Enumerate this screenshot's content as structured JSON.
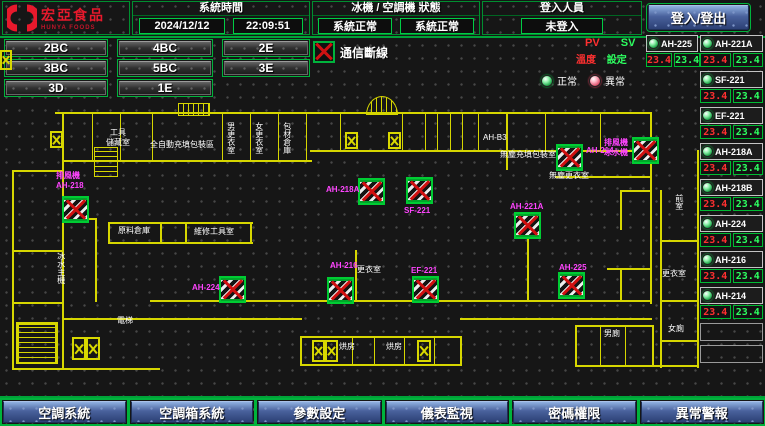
{
  "header": {
    "logo_title": "宏亞食品",
    "logo_subtitle": "HUNYA FOODS",
    "system_time_label": "系統時間",
    "date": "2024/12/12",
    "time": "22:09:51",
    "machine_status_label": "冰機 / 空調機 狀態",
    "chiller_status": "系統正常",
    "ahu_status": "系統正常",
    "login_label": "登入人員",
    "login_value": "未登入",
    "login_button": "登入/登出"
  },
  "floor_nav": {
    "rows": [
      [
        "2BC",
        "4BC",
        "2E"
      ],
      [
        "3BC",
        "5BC",
        "3E"
      ],
      [
        "3D",
        "1E"
      ]
    ]
  },
  "legend": {
    "comm_loss": "通信斷線",
    "pv": "PV",
    "sv": "SV",
    "pv_name": "溫度",
    "sv_name": "設定",
    "normal": "正常",
    "abnormal": "異常",
    "pv_color": "#ff3030",
    "sv_color": "#2dff60",
    "normal_color": "#22aa4e",
    "abnormal_color": "#e05570"
  },
  "units_panel": {
    "left": [
      {
        "name": "AH-225",
        "pv": "23.4",
        "sv": "23.4",
        "status": "normal"
      }
    ],
    "right": [
      {
        "name": "AH-221A",
        "pv": "23.4",
        "sv": "23.4",
        "status": "normal"
      },
      {
        "name": "SF-221",
        "pv": "23.4",
        "sv": "23.4",
        "status": "normal"
      },
      {
        "name": "EF-221",
        "pv": "23.4",
        "sv": "23.4",
        "status": "normal"
      },
      {
        "name": "AH-218A",
        "pv": "23.4",
        "sv": "23.4",
        "status": "normal"
      },
      {
        "name": "AH-218B",
        "pv": "23.4",
        "sv": "23.4",
        "status": "normal"
      },
      {
        "name": "AH-224",
        "pv": "23.4",
        "sv": "23.4",
        "status": "normal"
      },
      {
        "name": "AH-216",
        "pv": "23.4",
        "sv": "23.4",
        "status": "normal"
      },
      {
        "name": "AH-214",
        "pv": "23.4",
        "sv": "23.4",
        "status": "normal"
      }
    ],
    "spare_slots": 2
  },
  "floorplan": {
    "ahu_icons": [
      {
        "x": 62,
        "y": 196
      },
      {
        "x": 358,
        "y": 178
      },
      {
        "x": 406,
        "y": 177
      },
      {
        "x": 556,
        "y": 144
      },
      {
        "x": 632,
        "y": 137
      },
      {
        "x": 514,
        "y": 212
      },
      {
        "x": 219,
        "y": 276
      },
      {
        "x": 327,
        "y": 277
      },
      {
        "x": 412,
        "y": 276
      },
      {
        "x": 558,
        "y": 272
      }
    ],
    "dampers": [
      {
        "x": 345,
        "y": 132,
        "w": 13,
        "h": 17
      },
      {
        "x": 388,
        "y": 132,
        "w": 13,
        "h": 17
      },
      {
        "x": 72,
        "y": 337,
        "w": 14,
        "h": 23
      },
      {
        "x": 86,
        "y": 337,
        "w": 14,
        "h": 23
      },
      {
        "x": 312,
        "y": 340,
        "w": 13,
        "h": 22
      },
      {
        "x": 325,
        "y": 340,
        "w": 13,
        "h": 22
      },
      {
        "x": 417,
        "y": 340,
        "w": 14,
        "h": 22
      },
      {
        "x": 0,
        "y": 50,
        "w": 12,
        "h": 20
      },
      {
        "x": 50,
        "y": 131,
        "w": 13,
        "h": 17
      }
    ],
    "labels": [
      {
        "t": "排風機",
        "x": 56,
        "y": 172,
        "c": "m"
      },
      {
        "t": "AH-218",
        "x": 56,
        "y": 182,
        "c": "m"
      },
      {
        "t": "AH-218A",
        "x": 326,
        "y": 186,
        "c": "m"
      },
      {
        "t": "SF-221",
        "x": 404,
        "y": 207,
        "c": "m"
      },
      {
        "t": "AH-214",
        "x": 586,
        "y": 147,
        "c": "m"
      },
      {
        "t": "無塵充填包裝室",
        "x": 500,
        "y": 151,
        "c": "w"
      },
      {
        "t": "無塵更衣室",
        "x": 549,
        "y": 172,
        "c": "w"
      },
      {
        "t": "排風機",
        "x": 604,
        "y": 139,
        "c": "m"
      },
      {
        "t": "冰水機",
        "x": 604,
        "y": 149,
        "c": "m"
      },
      {
        "t": "AH-221A",
        "x": 510,
        "y": 203,
        "c": "m"
      },
      {
        "t": "AH-224",
        "x": 192,
        "y": 284,
        "c": "m"
      },
      {
        "t": "AH-216",
        "x": 330,
        "y": 262,
        "c": "m"
      },
      {
        "t": "更衣室",
        "x": 357,
        "y": 266,
        "c": "w"
      },
      {
        "t": "EF-221",
        "x": 411,
        "y": 267,
        "c": "m"
      },
      {
        "t": "AH-225",
        "x": 559,
        "y": 264,
        "c": "m"
      },
      {
        "t": "工具",
        "x": 110,
        "y": 129,
        "c": "w"
      },
      {
        "t": "儲藏室",
        "x": 106,
        "y": 139,
        "c": "w"
      },
      {
        "t": "全自動充填包裝區",
        "x": 150,
        "y": 141,
        "c": "w"
      },
      {
        "t": "男更衣室",
        "x": 226,
        "y": 122,
        "c": "w",
        "v": true
      },
      {
        "t": "女更衣室",
        "x": 254,
        "y": 122,
        "c": "w",
        "v": true
      },
      {
        "t": "包材倉庫",
        "x": 282,
        "y": 122,
        "c": "w",
        "v": true
      },
      {
        "t": "AH-B3",
        "x": 483,
        "y": 134,
        "c": "w"
      },
      {
        "t": "原料倉庫",
        "x": 118,
        "y": 227,
        "c": "w"
      },
      {
        "t": "維修工具室",
        "x": 194,
        "y": 228,
        "c": "w"
      },
      {
        "t": "冰水主機",
        "x": 56,
        "y": 252,
        "c": "w",
        "v": true
      },
      {
        "t": "電梯",
        "x": 117,
        "y": 317,
        "c": "w"
      },
      {
        "t": "烘房",
        "x": 339,
        "y": 343,
        "c": "w"
      },
      {
        "t": "烘房",
        "x": 386,
        "y": 343,
        "c": "w"
      },
      {
        "t": "男廁",
        "x": 604,
        "y": 330,
        "c": "w"
      },
      {
        "t": "女廁",
        "x": 668,
        "y": 325,
        "c": "w"
      },
      {
        "t": "前室",
        "x": 674,
        "y": 194,
        "c": "w",
        "v": true
      },
      {
        "t": "更衣室",
        "x": 662,
        "y": 270,
        "c": "w"
      }
    ]
  },
  "bottom_nav": [
    "空調系統",
    "空調箱系統",
    "參數設定",
    "儀表監視",
    "密碼權限",
    "異常警報"
  ]
}
